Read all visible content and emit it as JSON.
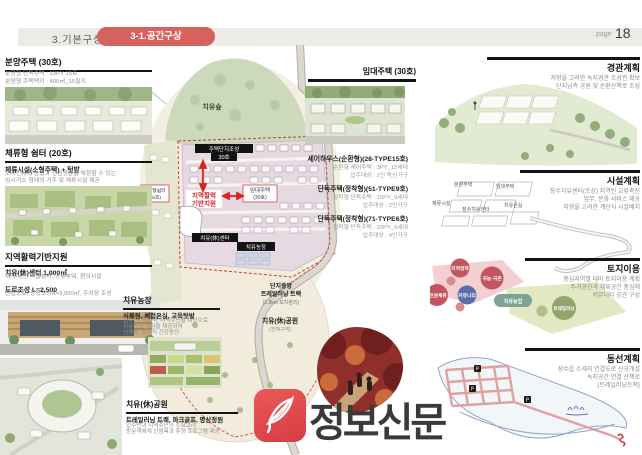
{
  "header": {
    "section_label": "3.기본구상",
    "tab_label": "3-1.공간구상",
    "page_word": "page",
    "page_number": "18"
  },
  "left": {
    "box1": {
      "title": "분양주택 (30호)",
      "line1": "분양형 단독주택 : 23PY 15호",
      "line2": "분양형 주택택지 : 400㎡_15필지"
    },
    "box2": {
      "title": "체류형 쉼터 (20호)",
      "subtitle": "체류시설(소형주택) + 텃밭",
      "desc1": "도시민에게 농업과 전원생활을 체험할 수 있는",
      "desc2": "임시거소 형태의 거주 및 체류시설 제공"
    },
    "box3": {
      "title": "지역활력기반지원",
      "item1_title": "치유(休)센터 1,000㎡",
      "item1_desc": "워케이션, 마을쉼터, 공유부엌, 편의시설",
      "item2_title": "도로조성 L=2,500",
      "item2_desc": "진입도로, 광장조성A=3,000㎡, 주차장 조성"
    }
  },
  "map": {
    "forest_label": "치유숲",
    "band_housing": "주택단지조성",
    "band_housing_count": "30호",
    "rental_label": "임대주택",
    "rental_count": "(30호)",
    "vitality_line1": "지역활력",
    "vitality_line2": "기반지원",
    "stay_label": "체류형쉼터",
    "stay_count": "(20호)",
    "center_band": "치유(休)센터",
    "farm_band": "치유농장",
    "track_line1": "단지중앙",
    "track_line2": "트레일러닝 트랙",
    "track_line3": "(1.8km 보차분리)",
    "park_label": "치유(休)공원",
    "park_sub": "(전체구역)"
  },
  "callouts": {
    "rental": {
      "title": "임대주택 (30호)"
    },
    "share": {
      "title": "셰어하우스(순환형)(28-TYPE15호)",
      "line1": "순환형 셰어주택 : 3PY_15세대",
      "line2": "입주대상 : 1인 독신가구"
    },
    "detach1": {
      "title": "단독주택(정착형)(51-TYPE9호)",
      "line1": "정착형 단독주택 : 15PY_9세대",
      "line2": "입주대상 : 2인가구"
    },
    "detach2": {
      "title": "단독주택(정착형)(71-TYPE6호)",
      "line1": "정착형 단독주택 : 23PY_6세대",
      "line2": "입주대상 : 4인가구"
    },
    "farm": {
      "title": "치유농장",
      "subtitle": "식물원, 체험온실, 교육텃밭",
      "desc1": "입주민, 방문객, 지역주민을 대상으로",
      "desc2": "치유농업 체험을 제공하여",
      "desc3": "신체적, 정신적 건강증진"
    },
    "park": {
      "title": "치유(休)공원",
      "subtitle": "트레일러닝 트랙, 파크골프, 명상정원",
      "desc1": "입주민과 지역주민의 수요고려",
      "desc2": "방문객에게 산림욕과 휴양 프로그램 제공"
    }
  },
  "right": {
    "landscape": {
      "title": "경관계획",
      "desc1": "지형을 고려한 녹지경관 조성권 확보",
      "desc2": "단지남측 공원 및 순환산책로 조성"
    },
    "facility": {
      "title": "시설계획",
      "desc1": "장수치유센터(조성) 지역민 교류촉진",
      "desc2": "업무, 문화 서비스 제공",
      "desc3": "지형을 고려한 계단식 시설배치",
      "label1": "분양주택",
      "label2": "임대주택",
      "label3": "체류시설",
      "label4": "장수치유센터",
      "label5": "치유온실"
    },
    "landuse": {
      "title": "토지이용",
      "desc1": "중심지역별 테마 토지이용 계획",
      "desc2": "주거공간과 체류공간 중심에",
      "desc3": "커뮤니티 공간 구성",
      "b1": "지역정착",
      "b2": "귀농·귀촌",
      "b3": "커뮤니티",
      "b4": "전원체류",
      "b5": "치유농업",
      "b6": "트레일러닝"
    },
    "circulation": {
      "title": "동선계획",
      "desc1": "장수읍 소재지 연결도로 신규개설",
      "desc2": "녹지공간 연결 산책로",
      "desc3": "(트레일러닝트랙)",
      "p_label": "P"
    }
  },
  "watermark": {
    "brand": "정보신문"
  },
  "colors": {
    "accent_red": "#d5625c",
    "band_black": "#131313"
  }
}
